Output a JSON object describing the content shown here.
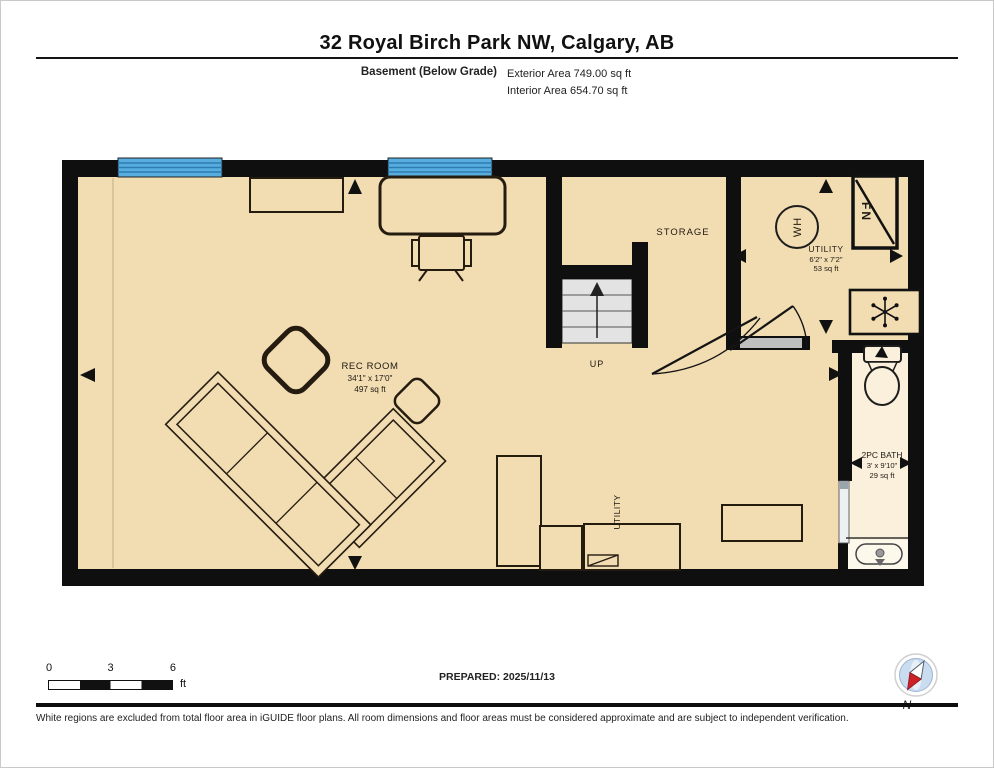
{
  "header": {
    "title": "32 Royal Birch Park NW, Calgary, AB",
    "floor_label": "Basement (Below Grade)",
    "exterior_area": "Exterior Area 749.00 sq ft",
    "interior_area": "Interior Area 654.70 sq ft"
  },
  "rooms": {
    "rec_room": {
      "name": "REC ROOM",
      "dims": "34'1\" x 17'0\"",
      "area": "497 sq ft"
    },
    "storage": {
      "name": "STORAGE"
    },
    "utility": {
      "name": "UTILITY",
      "dims": "6'2\" x 7'2\"",
      "area": "53 sq ft"
    },
    "bath": {
      "name": "2PC BATH",
      "dims": "3' x 9'10\"",
      "area": "29 sq ft"
    },
    "utility_nook": {
      "name": "UTILITY"
    }
  },
  "stairs": {
    "direction_label": "UP"
  },
  "fixtures": {
    "water_heater_label": "WH",
    "furnace_label": "FN"
  },
  "legend": {
    "scale": {
      "tick_0": "0",
      "tick_3": "3",
      "tick_6": "6",
      "unit": "ft"
    },
    "prepared_label": "PREPARED: 2025/11/13",
    "compass_n": "N"
  },
  "footer": {
    "disclaimer": "White regions are excluded from total floor area in iGUIDE floor plans. All room dimensions and floor areas must be considered approximate and are subject to independent verification."
  },
  "colors": {
    "floor_tan": "#f2dcb2",
    "bath_cream": "#fbf0dc",
    "sink_alcove_cream": "#fdf8ec",
    "window_blue": "#57aede",
    "window_line_blue": "#2e7cb4",
    "stair_grey": "#e3e3e3",
    "wall_black": "#0f0f0f",
    "compass_red": "#cc2127",
    "compass_disc_blue": "#c9dcf0"
  }
}
